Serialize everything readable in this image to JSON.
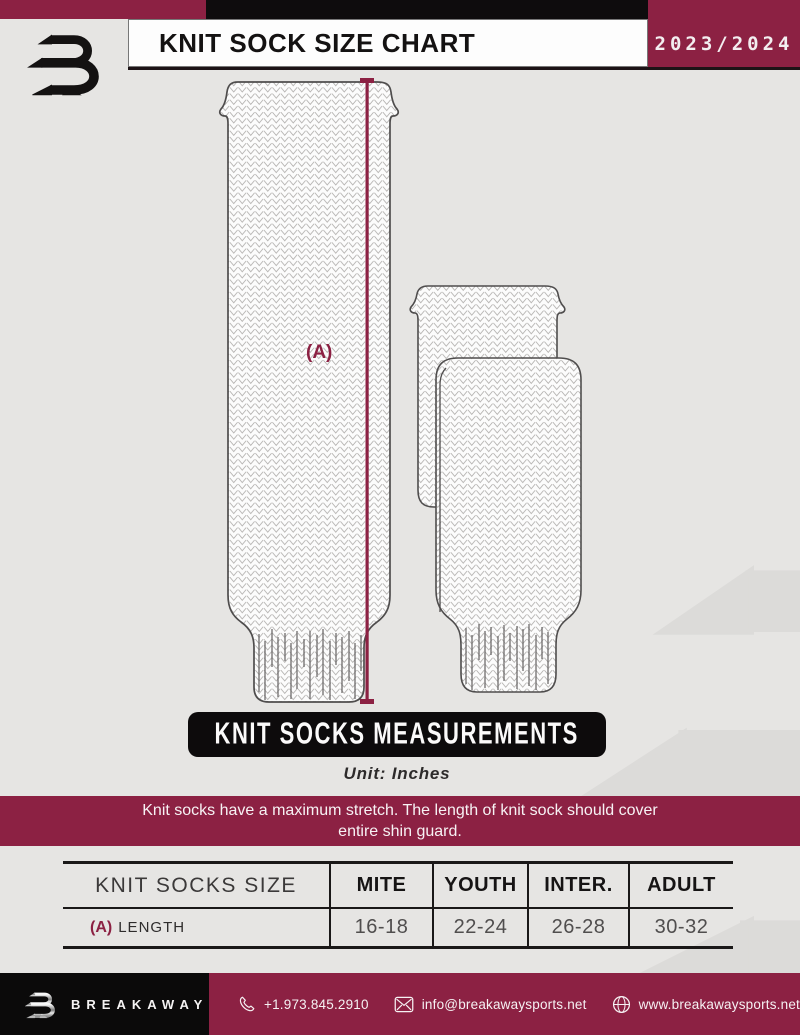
{
  "header": {
    "title": "KNIT SOCK SIZE CHART",
    "season": "2023/2024"
  },
  "diagram": {
    "measure_label": "(A)"
  },
  "measurements": {
    "banner": "KNIT SOCKS MEASUREMENTS",
    "unit_note": "Unit: Inches",
    "note_line1": "Knit socks have a maximum stretch. The length of knit sock should cover",
    "note_line2": "entire shin guard."
  },
  "table": {
    "size_header": "KNIT SOCKS SIZE",
    "columns": [
      "MITE",
      "YOUTH",
      "INTER.",
      "ADULT"
    ],
    "row": {
      "prefix": "(A)",
      "label": "LENGTH",
      "values": [
        "16-18",
        "22-24",
        "26-28",
        "30-32"
      ]
    }
  },
  "footer": {
    "brand": "BREAKAWAY",
    "phone": "+1.973.845.2910",
    "email": "info@breakawaysports.net",
    "website": "www.breakawaysports.net"
  },
  "colors": {
    "maroon": "#8C2143",
    "ink": "#121010",
    "background": "#E6E5E3"
  }
}
